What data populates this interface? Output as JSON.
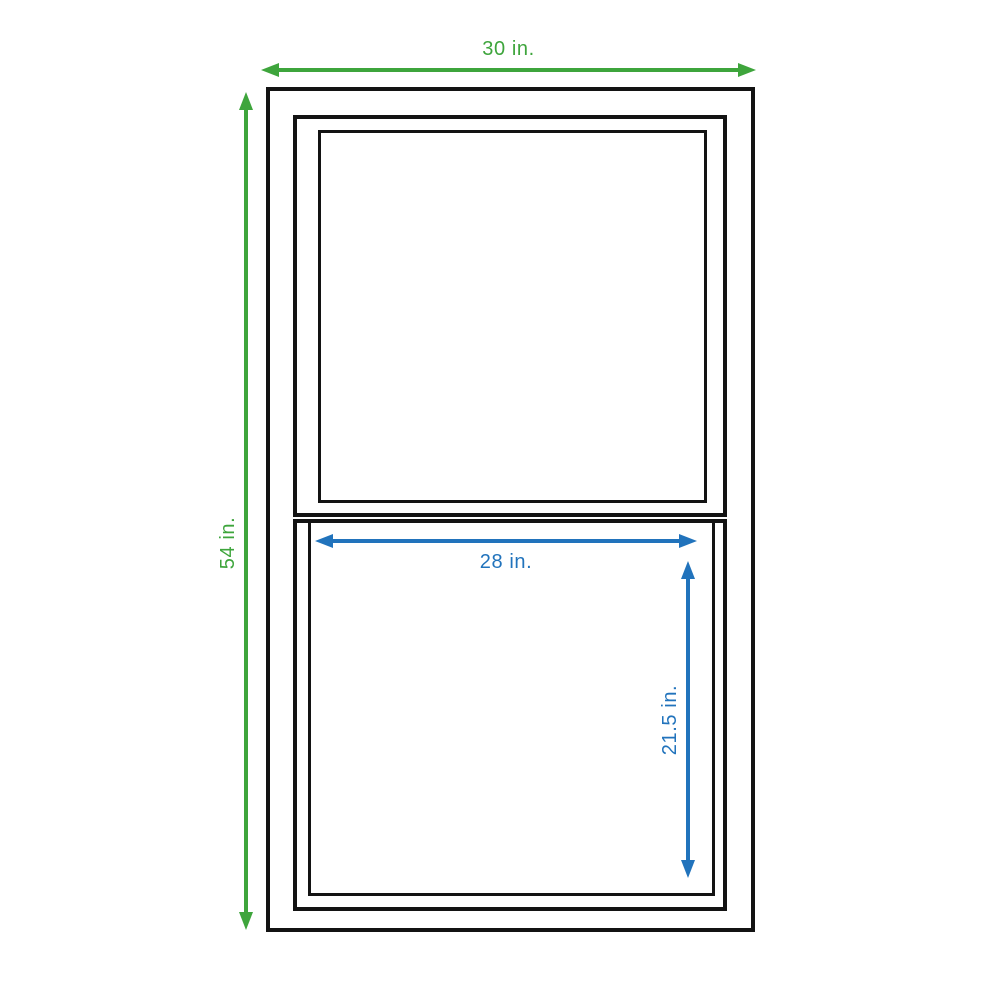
{
  "diagram": {
    "subject": "double-hung window dimension drawing",
    "dimensions": {
      "overall_width": {
        "label": "30 in.",
        "value": 30,
        "unit": "in."
      },
      "overall_height": {
        "label": "54 in.",
        "value": 54,
        "unit": "in."
      },
      "sash_width": {
        "label": "28 in.",
        "value": 28,
        "unit": "in."
      },
      "sash_height": {
        "label": "21.5 in.",
        "value": 21.5,
        "unit": "in."
      }
    }
  },
  "colors": {
    "dimension_primary": "#3ea53c",
    "dimension_secondary": "#2173bc",
    "frame": "#131313",
    "background": "#ffffff"
  }
}
